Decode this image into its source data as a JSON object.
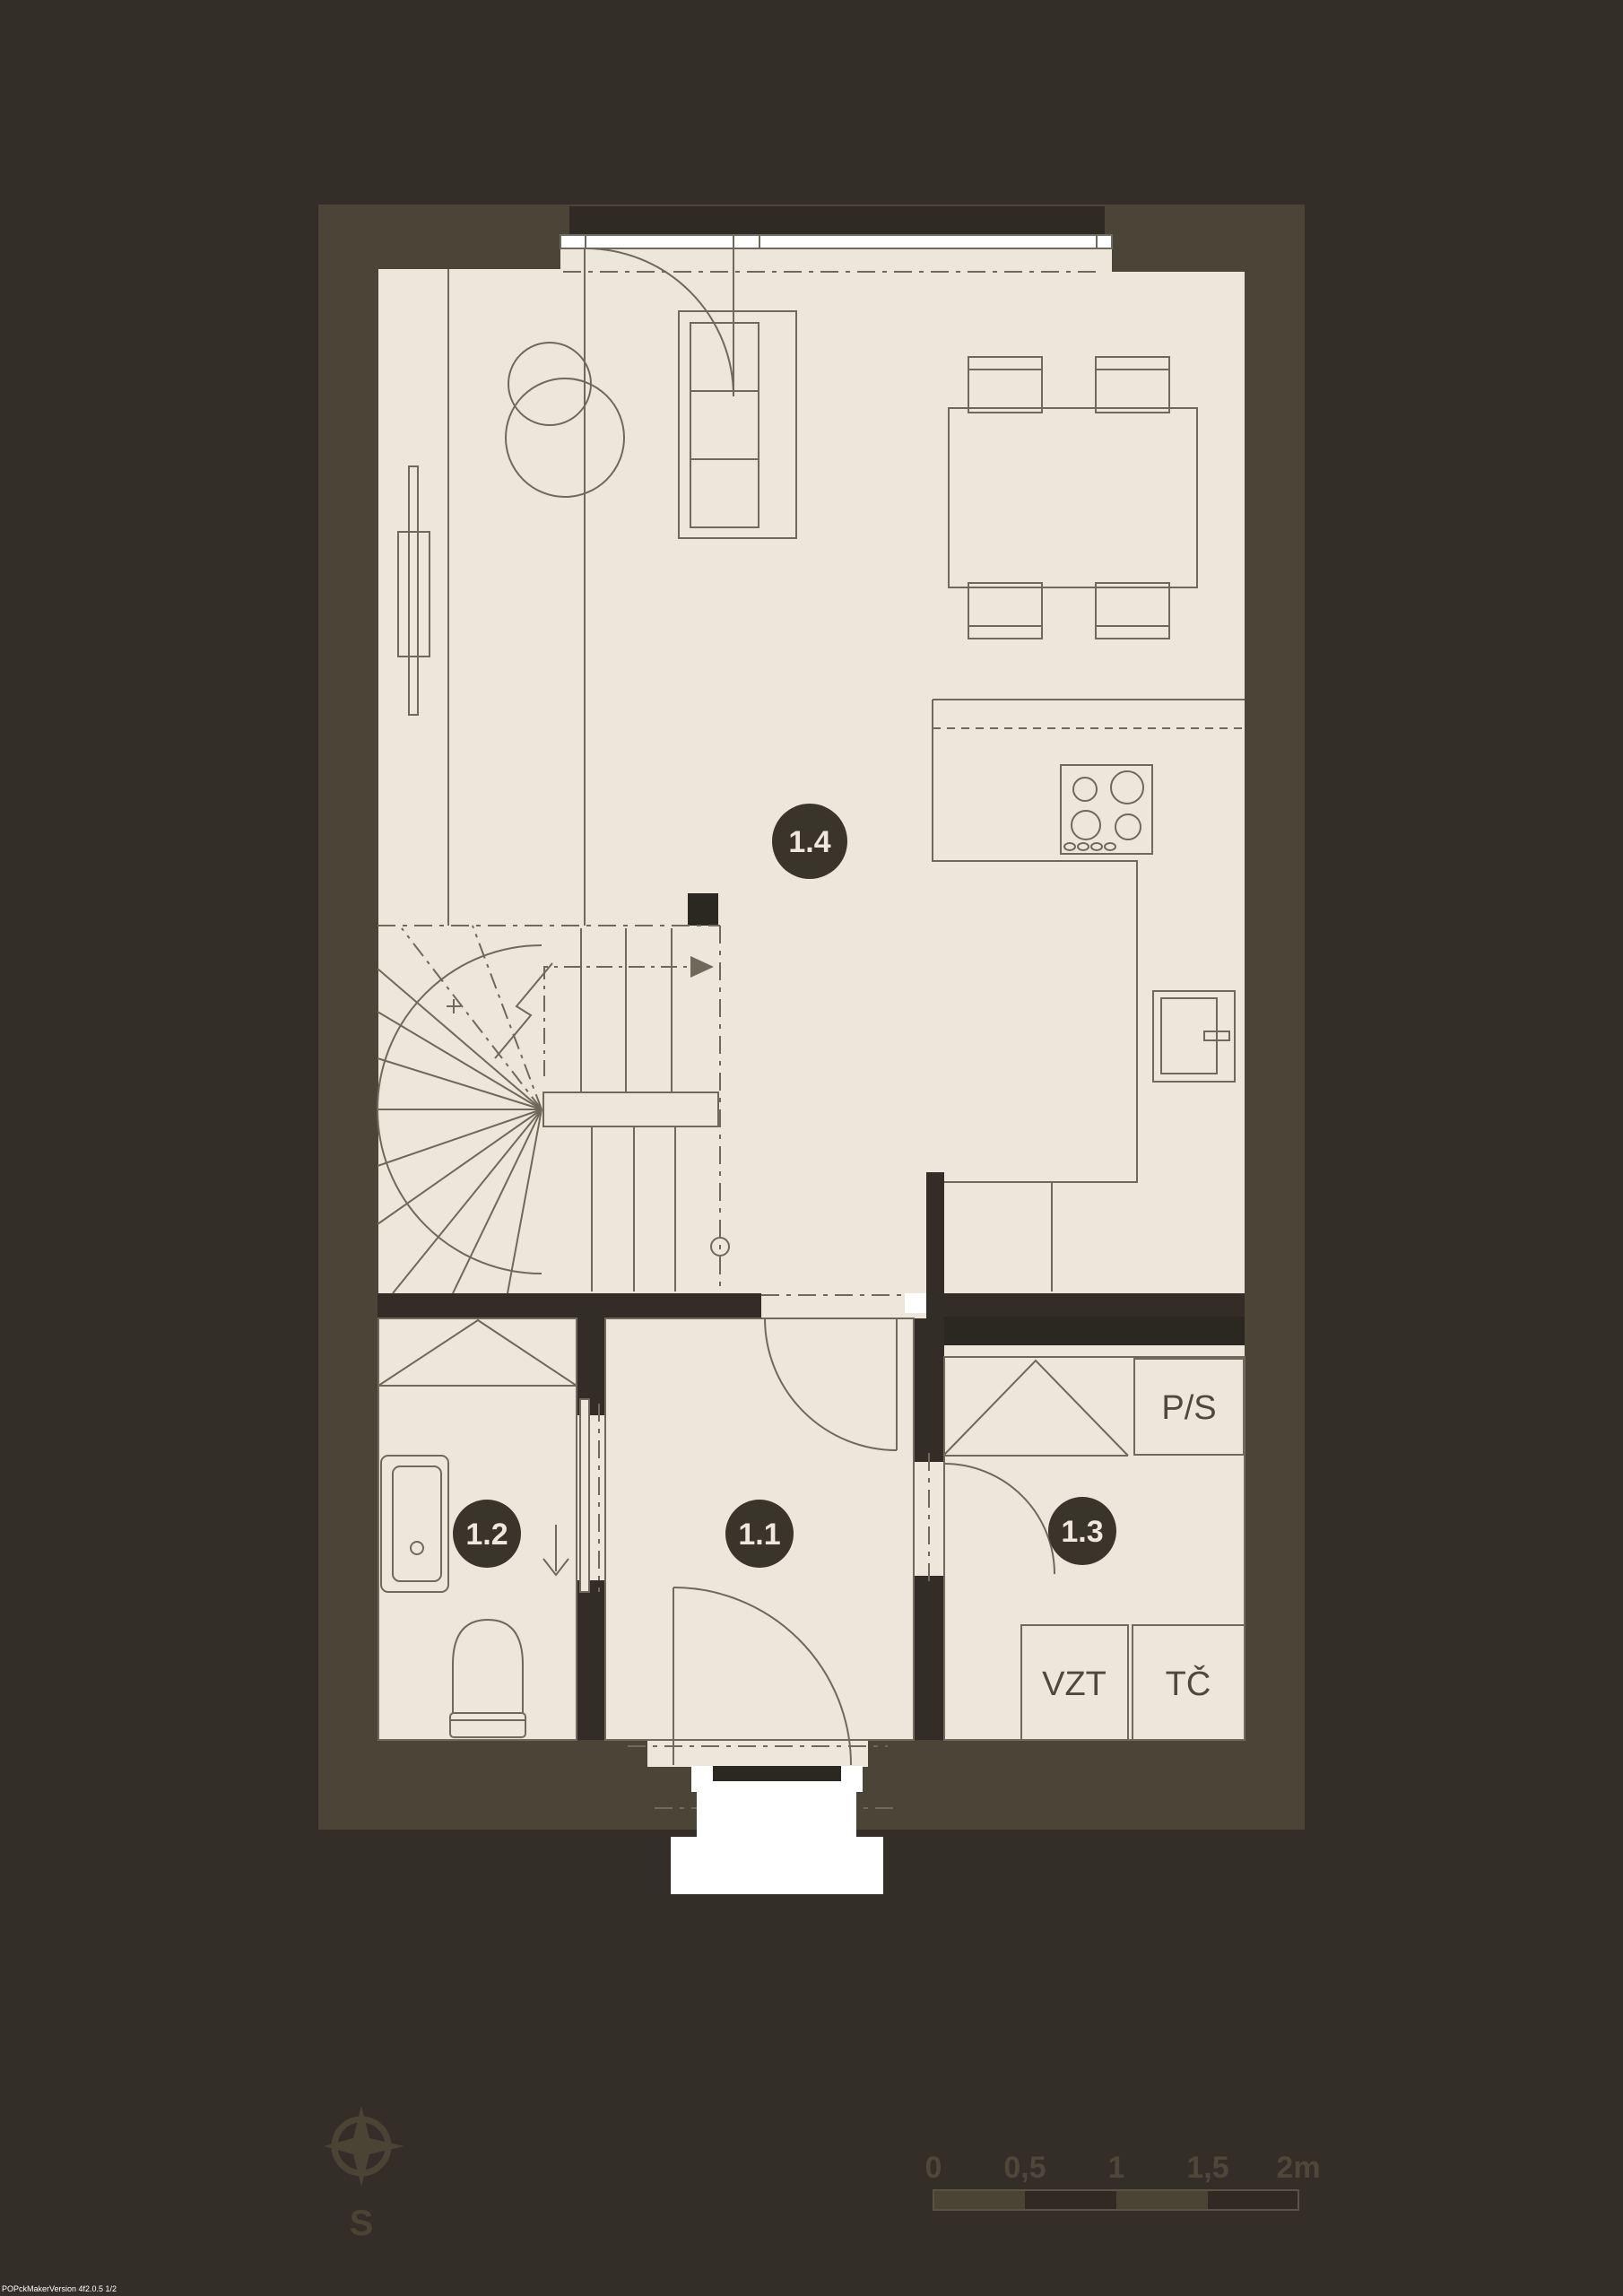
{
  "plan": {
    "type": "floor-plan",
    "floor": "ground floor",
    "rooms": [
      {
        "id": "1.1",
        "name": "entrance-hall"
      },
      {
        "id": "1.2",
        "name": "bathroom"
      },
      {
        "id": "1.3",
        "name": "technical-room"
      },
      {
        "id": "1.4",
        "name": "living-room-with-kitchen"
      }
    ],
    "equipment": {
      "washer_dryer": "P/S",
      "ventilation_unit": "VZT",
      "heat_pump": "TČ"
    }
  },
  "scale_bar": {
    "labels": [
      "0",
      "0,5",
      "1",
      "1,5",
      "2m"
    ],
    "unit": "m"
  },
  "compass": {
    "south_label": "S"
  },
  "watermark": "POPckMakerVersion 4f2.0.5 1/2",
  "colors": {
    "background": "#332f28",
    "plot_zone": "#4a4537",
    "floor": "#ede6da",
    "line": "#6f695b",
    "wall": "#322d26",
    "dark_stripe": "#2b2721",
    "label_circle": "#3a352b",
    "white": "#ffffff"
  }
}
